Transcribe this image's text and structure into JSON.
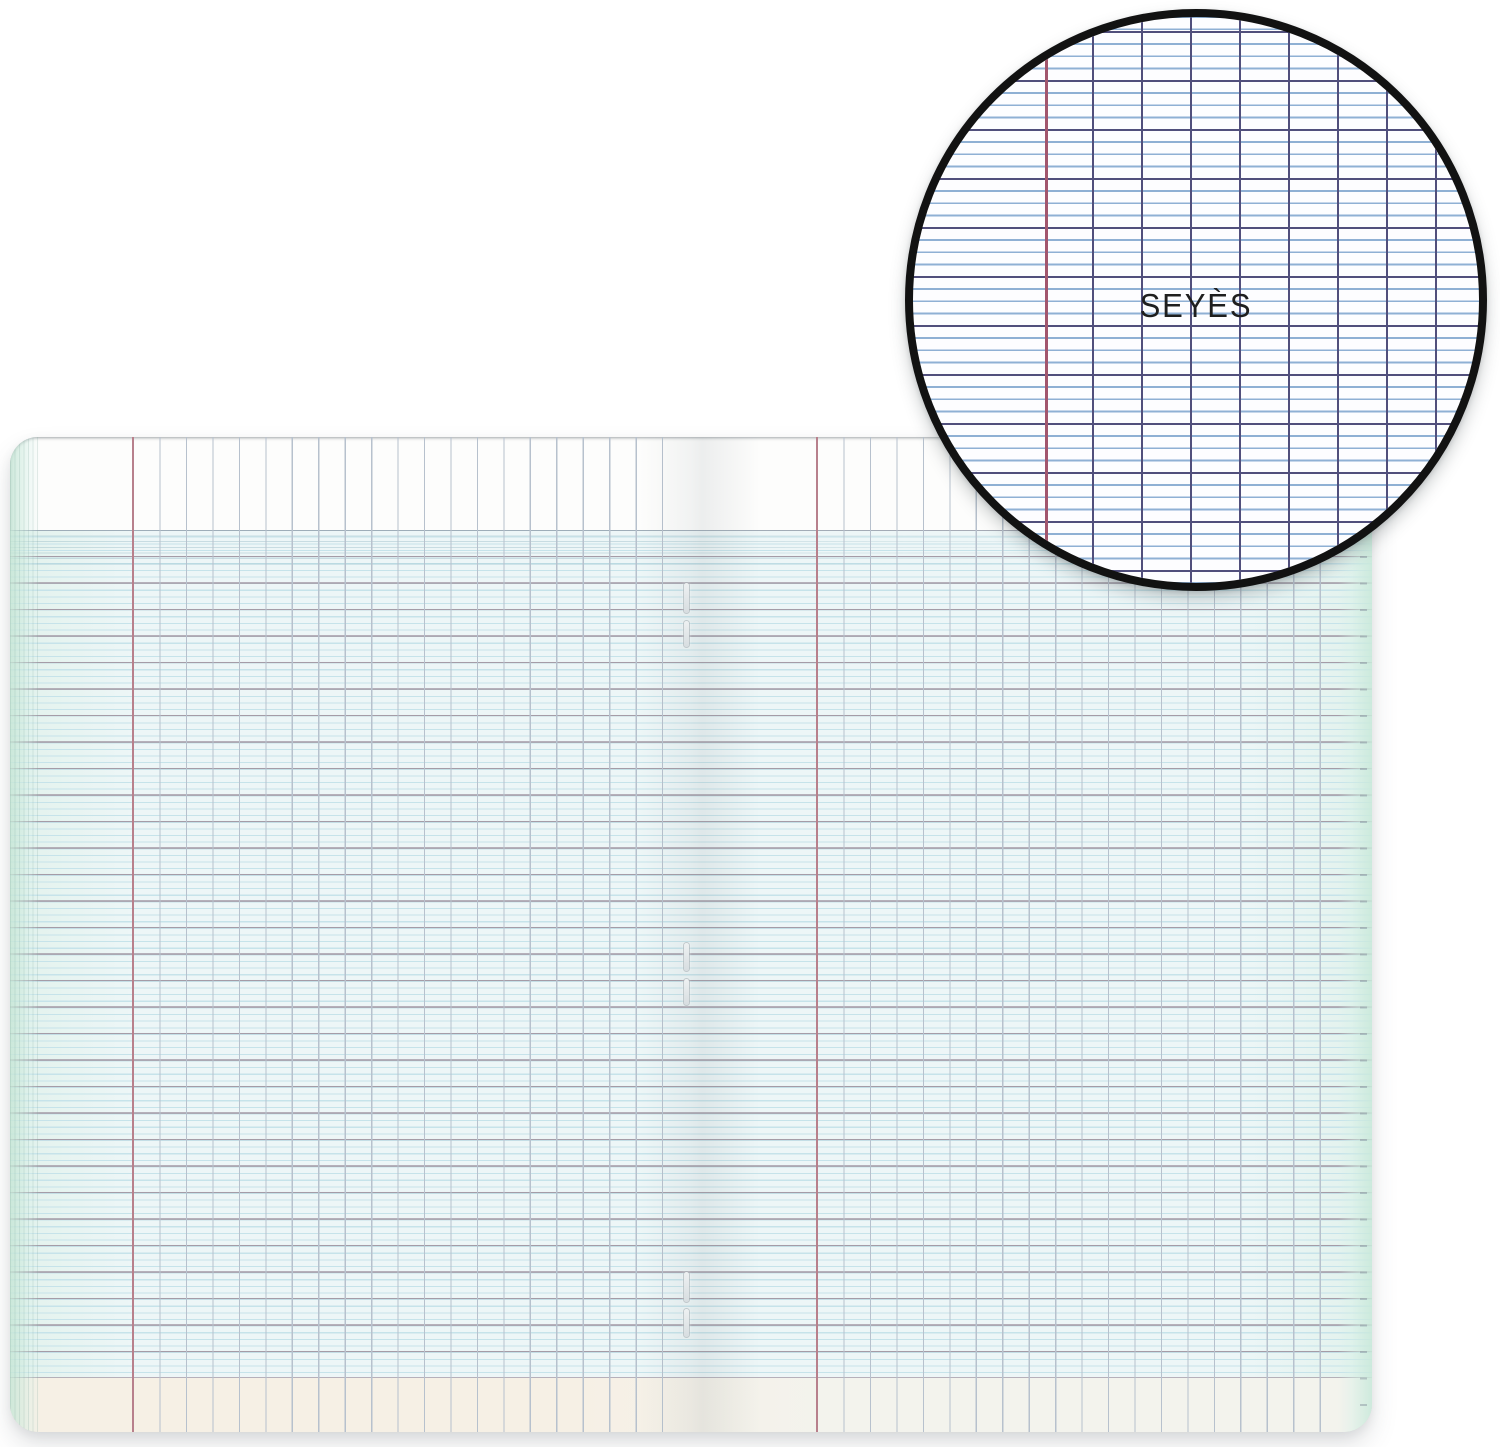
{
  "meta": {
    "description": "Product photo of an open French school notebook with Seyès (grand carreaux) ruling and a circular magnifier inset showing the ruling pattern",
    "staple_count": 3
  },
  "inset": {
    "label": "SEYÈS"
  },
  "theme": {
    "page-bg": "#ffffff",
    "paper": "#fdfdfc",
    "grid-tint": "#edf6f7",
    "grid-minor": "#c6e3ea",
    "grid-major": "#a49ba6",
    "grid-vline": "#b7c1cd",
    "margin-red": "#b8808c",
    "bottom-left": "#f6f0e5",
    "bottom-right": "#f3f3ed",
    "edge-mint": "#e2f2ec",
    "staple-fill": "#eef1f2",
    "staple-edge": "rgba(150,160,166,.5)",
    "inset-border": "#121212",
    "inset-paper": "#fdfdff",
    "inset-major": "#514f7c",
    "inset-minor": "#8fb0d4",
    "inset-red": "#a2566e",
    "inset-text": "#1f1f1f"
  }
}
